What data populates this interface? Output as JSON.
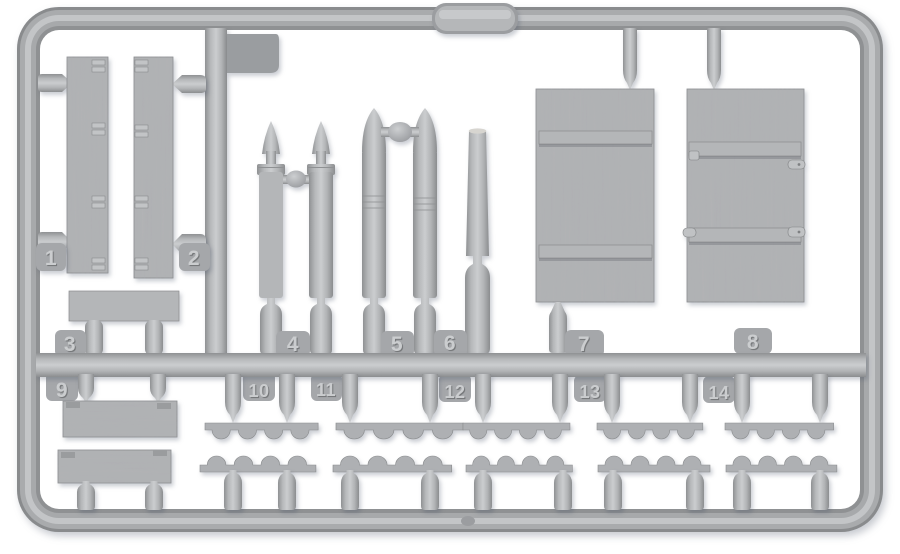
{
  "description": "Light grey injection-moulded plastic model-kit sprue photographed on white: two slatted planks, artillery shells, a tapered barrel, two wood-grain crate panels, bottom planks and scalloped rack strips, with embossed part-number tags",
  "canvas": {
    "background": "#ffffff"
  },
  "colors": {
    "bg": "#ffffff",
    "plastic_base": "#a9abad",
    "plastic_mid": "#b4b6b8",
    "plastic_light": "#c9cbcd",
    "plastic_dark": "#8e9092",
    "tag_fill": "#a5a7aa",
    "number_fill": "#cbcdcf",
    "number_shadow": "#76787a",
    "dark_tab": "#9a9da0",
    "wood_fill": "#b2b4b6"
  },
  "part_tags": [
    {
      "number": "1"
    },
    {
      "number": "2"
    },
    {
      "number": "3"
    },
    {
      "number": "4"
    },
    {
      "number": "5"
    },
    {
      "number": "6"
    },
    {
      "number": "7"
    },
    {
      "number": "8"
    },
    {
      "number": "9"
    },
    {
      "number": "10"
    },
    {
      "number": "11"
    },
    {
      "number": "12"
    },
    {
      "number": "13"
    },
    {
      "number": "14"
    }
  ]
}
